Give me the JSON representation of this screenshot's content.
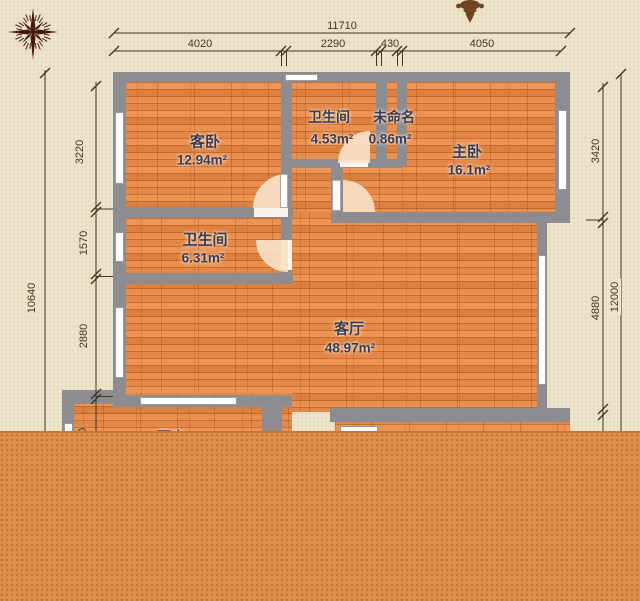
{
  "page": {
    "background_color": "#EDE3C9",
    "cover_color": "#DF8F4B",
    "wall_color": "#8D8D91",
    "floor_color": "#DD7B36"
  },
  "icons": {
    "compass": "compass-rose",
    "ornament": "fleur-ornament"
  },
  "rooms": [
    {
      "id": "guest-bedroom",
      "name": "客卧",
      "area": "12.94m²"
    },
    {
      "id": "bathroom-top",
      "name": "卫生间",
      "area": "4.53m²"
    },
    {
      "id": "unnamed-shaft",
      "name": "未命名",
      "area": "0.86m²"
    },
    {
      "id": "master-bedroom",
      "name": "主卧",
      "area": "16.1m²"
    },
    {
      "id": "bathroom-mid",
      "name": "卫生间",
      "area": "6.31m²"
    },
    {
      "id": "living-room",
      "name": "客厅",
      "area": "48.97m²"
    },
    {
      "id": "kitchen-clipped",
      "name": "厨房",
      "area": ""
    }
  ],
  "dims": {
    "top_total": "11710",
    "top_segments": [
      "4020",
      "2290",
      "430",
      "4050"
    ],
    "left_total": "10640",
    "left_segments": [
      "3220",
      "1570",
      "2880",
      "930"
    ],
    "right_total": "12000",
    "right_segments": [
      "3420",
      "4880"
    ]
  }
}
